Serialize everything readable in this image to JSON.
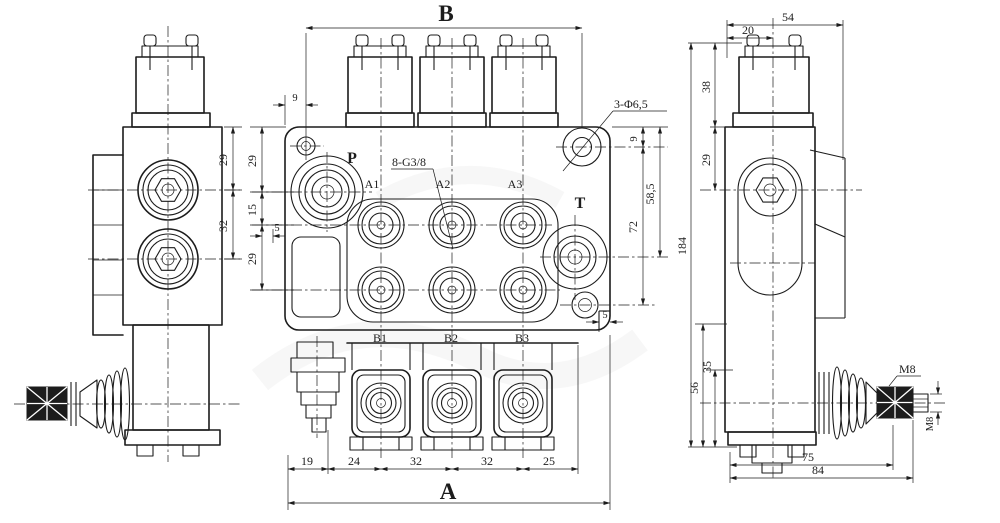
{
  "title": "hydraulic-monoblock-valve-3-spool-drawing",
  "colors": {
    "ink": "#1c1c1c",
    "paper": "#ffffff"
  },
  "front": {
    "dim_b": "B",
    "dim_a": "A",
    "dim_9_top": "9",
    "chain_left": [
      "29",
      "15",
      "29"
    ],
    "dim_5_left": "5",
    "dim_5_right": "5",
    "port_p": "P",
    "port_t": "T",
    "port_a1": "A1",
    "port_a2": "A2",
    "port_a3": "A3",
    "port_b1": "B1",
    "port_b2": "B2",
    "port_b3": "B3",
    "callout_thread": "8-G3/8",
    "callout_holes": "3-Φ6,5",
    "dim_9_right": "9",
    "dim_585": "58,5",
    "dim_72": "72",
    "chain_bottom": [
      "19",
      "24",
      "32",
      "32",
      "25"
    ]
  },
  "side": {
    "dim_29": "29",
    "dim_32": "32"
  },
  "rear": {
    "dim_54": "54",
    "dim_20": "20",
    "dim_38": "38",
    "dim_29": "29",
    "dim_184": "184",
    "dim_56": "56",
    "dim_35": "35",
    "dim_75": "75",
    "dim_84": "84",
    "m8_top": "M8",
    "m8_side": "M8"
  }
}
